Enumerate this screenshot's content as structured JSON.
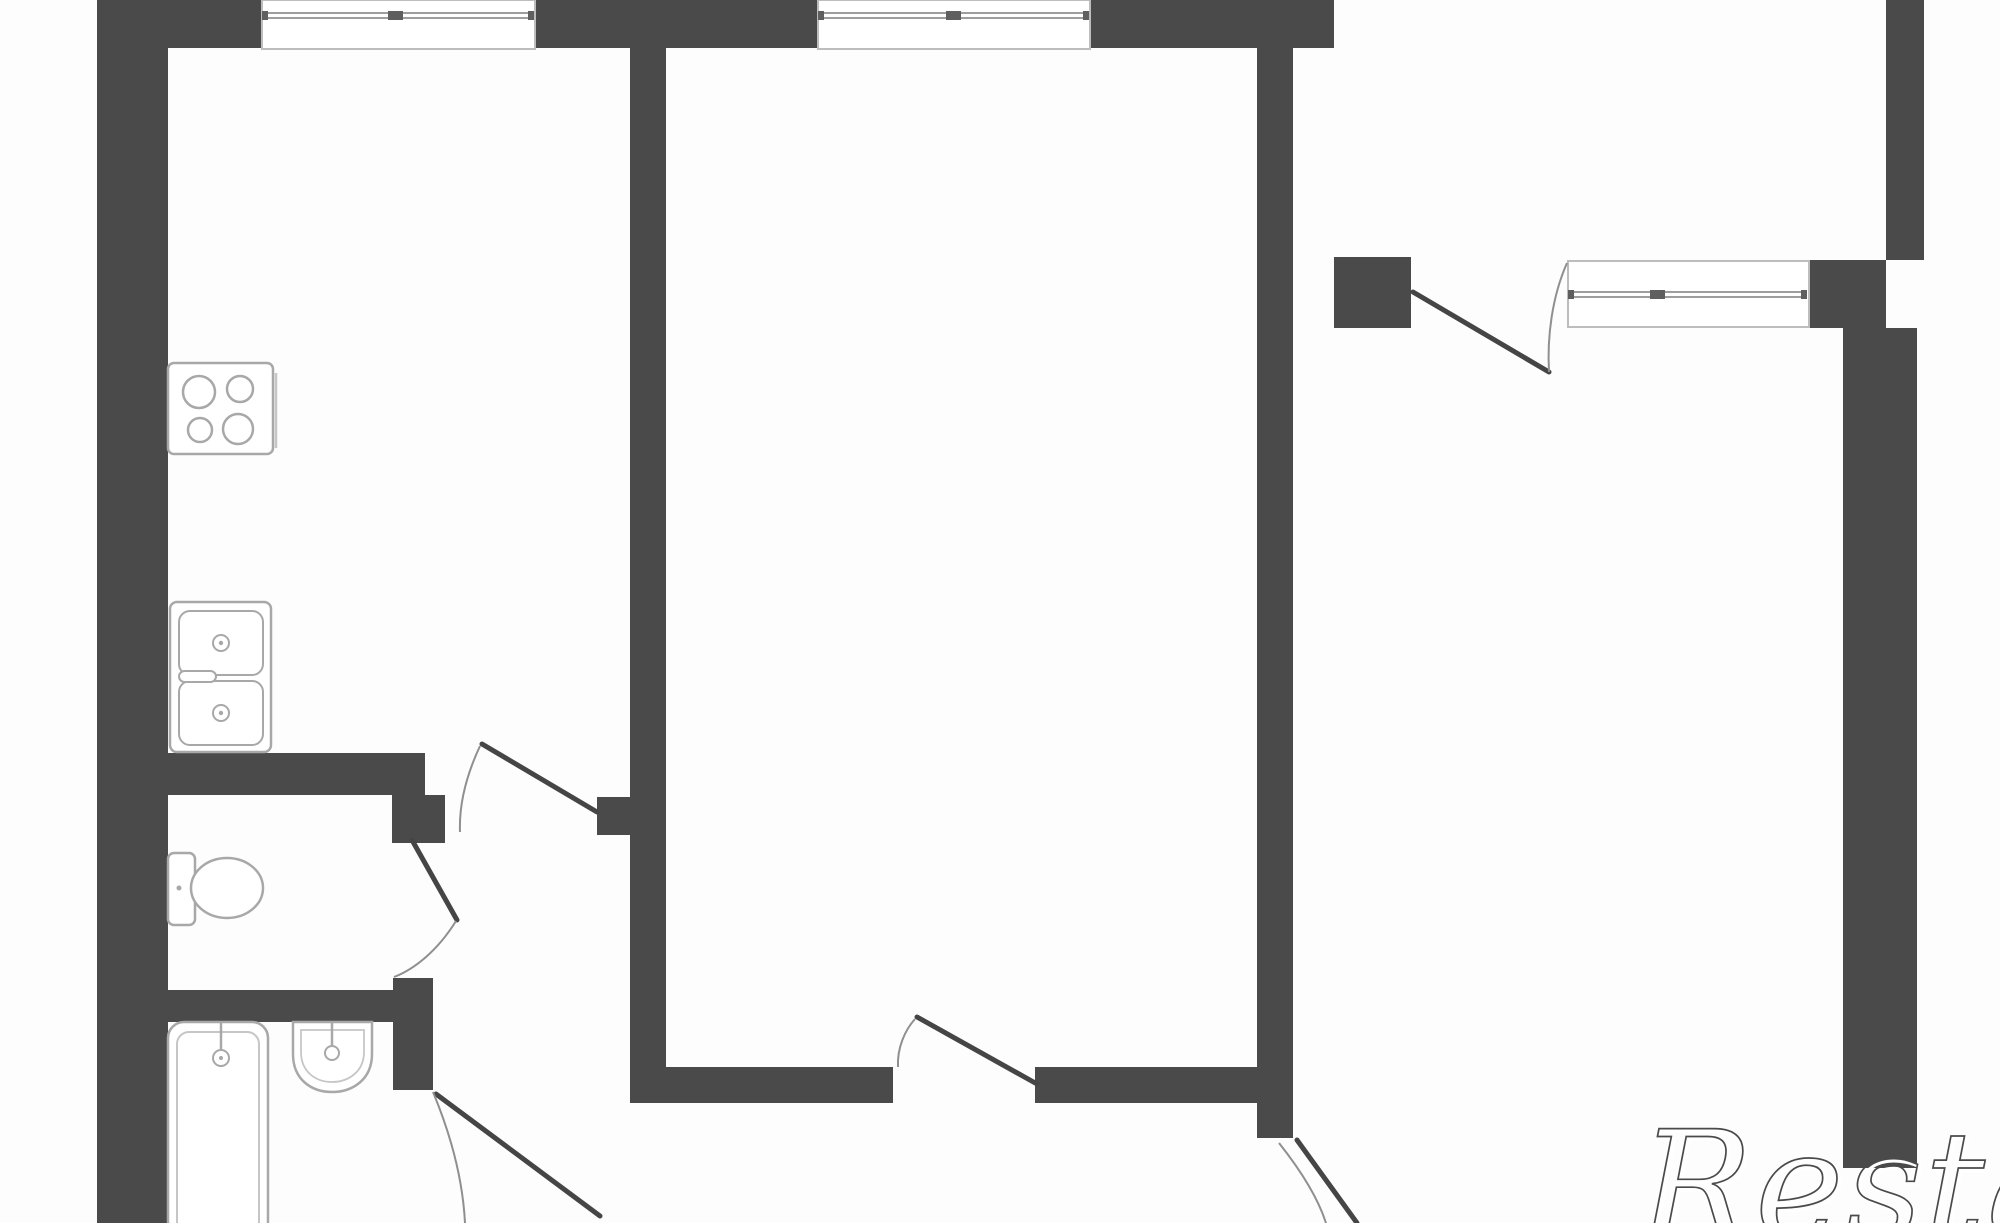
{
  "meta": {
    "title": "apartment-floor-plan",
    "canvas": {
      "width": 2000,
      "height": 1223,
      "background": "#fdfdfd"
    }
  },
  "watermark": {
    "text": "Restate"
  },
  "colors": {
    "wall": "#4a4a4a",
    "fixture": "#a8a8a8",
    "light": "#c6c6c6",
    "glass": "#9e9e9e",
    "frame": "#bdbdbd",
    "door": "#454545",
    "arc": "#8f8f8f",
    "tick": "#5f5f5f",
    "white": "#ffffff",
    "wmdark": "#4a4a4a"
  },
  "elements": [
    {
      "name": "walls",
      "type": "g",
      "items": [
        {
          "name": "left-outer-wall",
          "type": "rect",
          "x": 97,
          "y": 0,
          "w": 71,
          "h": 1223,
          "fill": "wall"
        },
        {
          "name": "top-wall-west",
          "type": "rect",
          "x": 97,
          "y": 0,
          "w": 165,
          "h": 48,
          "fill": "wall"
        },
        {
          "name": "top-wall-center",
          "type": "rect",
          "x": 535,
          "y": 0,
          "w": 283,
          "h": 48,
          "fill": "wall"
        },
        {
          "name": "top-wall-east",
          "type": "rect",
          "x": 1090,
          "y": 0,
          "w": 244,
          "h": 48,
          "fill": "wall"
        },
        {
          "name": "kitchen-livingroom-wall",
          "type": "rect",
          "x": 630,
          "y": 48,
          "w": 36,
          "h": 1052,
          "fill": "wall"
        },
        {
          "name": "kitchen-door-jamb",
          "type": "rect",
          "x": 597,
          "y": 797,
          "w": 36,
          "h": 38,
          "fill": "wall"
        },
        {
          "name": "kitchen-wc-wall",
          "type": "rect",
          "x": 140,
          "y": 753,
          "w": 285,
          "h": 42,
          "fill": "wall"
        },
        {
          "name": "wc-door-jamb",
          "type": "rect",
          "x": 392,
          "y": 795,
          "w": 53,
          "h": 48,
          "fill": "wall"
        },
        {
          "name": "wc-bathroom-wall",
          "type": "rect",
          "x": 140,
          "y": 990,
          "w": 253,
          "h": 32,
          "fill": "wall"
        },
        {
          "name": "bathroom-door-jamb",
          "type": "rect",
          "x": 393,
          "y": 978,
          "w": 40,
          "h": 112,
          "fill": "wall"
        },
        {
          "name": "hall-south-wall-west",
          "type": "rect",
          "x": 630,
          "y": 1067,
          "w": 263,
          "h": 36,
          "fill": "wall"
        },
        {
          "name": "hall-south-wall-east",
          "type": "rect",
          "x": 1035,
          "y": 1067,
          "w": 222,
          "h": 36,
          "fill": "wall"
        },
        {
          "name": "livingroom-right-wall",
          "type": "rect",
          "x": 1257,
          "y": 48,
          "w": 36,
          "h": 1090,
          "fill": "wall"
        },
        {
          "name": "rightroom-door-jamb",
          "type": "rect",
          "x": 1334,
          "y": 257,
          "w": 77,
          "h": 71,
          "fill": "wall"
        },
        {
          "name": "rightroom-window-pier",
          "type": "rect",
          "x": 1809,
          "y": 260,
          "w": 77,
          "h": 68,
          "fill": "wall"
        },
        {
          "name": "right-outer-wall-upper",
          "type": "rect",
          "x": 1886,
          "y": 0,
          "w": 38,
          "h": 260,
          "fill": "wall"
        },
        {
          "name": "right-outer-wall-lower",
          "type": "rect",
          "x": 1843,
          "y": 328,
          "w": 74,
          "h": 840,
          "fill": "wall"
        }
      ]
    },
    {
      "name": "kitchen-window",
      "type": "g",
      "items": [
        {
          "name": "window-box",
          "type": "rect",
          "x": 262,
          "y": 0,
          "w": 273,
          "h": 49,
          "fill": "white",
          "stroke": "frame",
          "sw": 2
        },
        {
          "name": "window-glass-line",
          "type": "line",
          "x1": 264,
          "y1": 13,
          "x2": 533,
          "y2": 13,
          "stroke": "glass",
          "sw": 2
        },
        {
          "name": "window-glass-line",
          "type": "line",
          "x1": 264,
          "y1": 18,
          "x2": 533,
          "y2": 18,
          "stroke": "glass",
          "sw": 2
        },
        {
          "name": "window-end-cap",
          "type": "rect",
          "x": 262,
          "y": 11,
          "w": 6,
          "h": 9,
          "fill": "tick"
        },
        {
          "name": "window-end-cap",
          "type": "rect",
          "x": 528,
          "y": 11,
          "w": 6,
          "h": 9,
          "fill": "tick"
        },
        {
          "name": "window-center-tick",
          "type": "rect",
          "x": 388,
          "y": 11,
          "w": 15,
          "h": 9,
          "fill": "tick"
        }
      ]
    },
    {
      "name": "livingroom-window",
      "type": "g",
      "items": [
        {
          "name": "window-box",
          "type": "rect",
          "x": 818,
          "y": 0,
          "w": 272,
          "h": 49,
          "fill": "white",
          "stroke": "frame",
          "sw": 2
        },
        {
          "name": "window-glass-line",
          "type": "line",
          "x1": 820,
          "y1": 13,
          "x2": 1088,
          "y2": 13,
          "stroke": "glass",
          "sw": 2
        },
        {
          "name": "window-glass-line",
          "type": "line",
          "x1": 820,
          "y1": 18,
          "x2": 1088,
          "y2": 18,
          "stroke": "glass",
          "sw": 2
        },
        {
          "name": "window-end-cap",
          "type": "rect",
          "x": 818,
          "y": 11,
          "w": 6,
          "h": 9,
          "fill": "tick"
        },
        {
          "name": "window-end-cap",
          "type": "rect",
          "x": 1083,
          "y": 11,
          "w": 6,
          "h": 9,
          "fill": "tick"
        },
        {
          "name": "window-center-tick",
          "type": "rect",
          "x": 946,
          "y": 11,
          "w": 15,
          "h": 9,
          "fill": "tick"
        }
      ]
    },
    {
      "name": "rightroom-window",
      "type": "g",
      "items": [
        {
          "name": "window-box",
          "type": "rect",
          "x": 1568,
          "y": 261,
          "w": 241,
          "h": 66,
          "fill": "white",
          "stroke": "frame",
          "sw": 2
        },
        {
          "name": "window-glass-line",
          "type": "line",
          "x1": 1570,
          "y1": 292,
          "x2": 1807,
          "y2": 292,
          "stroke": "glass",
          "sw": 2
        },
        {
          "name": "window-glass-line",
          "type": "line",
          "x1": 1570,
          "y1": 297,
          "x2": 1807,
          "y2": 297,
          "stroke": "glass",
          "sw": 2
        },
        {
          "name": "window-end-cap",
          "type": "rect",
          "x": 1568,
          "y": 290,
          "w": 6,
          "h": 9,
          "fill": "tick"
        },
        {
          "name": "window-end-cap",
          "type": "rect",
          "x": 1801,
          "y": 290,
          "w": 6,
          "h": 9,
          "fill": "tick"
        },
        {
          "name": "window-center-tick",
          "type": "rect",
          "x": 1650,
          "y": 290,
          "w": 15,
          "h": 9,
          "fill": "tick"
        }
      ]
    },
    {
      "name": "kitchen-door-swing",
      "type": "g",
      "items": [
        {
          "name": "door-leaf",
          "type": "line",
          "x1": 597,
          "y1": 812,
          "x2": 482,
          "y2": 744,
          "stroke": "door",
          "sw": 5,
          "cap": "round"
        },
        {
          "name": "door-arc",
          "type": "path",
          "d": "M 480 746 C 466 776 459 806 460 832",
          "stroke": "arc",
          "sw": 2,
          "fill": "none"
        }
      ]
    },
    {
      "name": "wc-door-swing",
      "type": "g",
      "items": [
        {
          "name": "door-leaf",
          "type": "line",
          "x1": 412,
          "y1": 840,
          "x2": 457,
          "y2": 920,
          "stroke": "door",
          "sw": 5,
          "cap": "round"
        },
        {
          "name": "door-arc",
          "type": "path",
          "d": "M 456 921 C 438 950 415 969 394 977",
          "stroke": "arc",
          "sw": 2,
          "fill": "none"
        }
      ]
    },
    {
      "name": "bathroom-door-swing",
      "type": "g",
      "items": [
        {
          "name": "door-leaf",
          "type": "line",
          "x1": 436,
          "y1": 1094,
          "x2": 600,
          "y2": 1216,
          "stroke": "door",
          "sw": 5,
          "cap": "round"
        },
        {
          "name": "door-arc",
          "type": "path",
          "d": "M 433 1092 C 453 1140 463 1184 465 1223",
          "stroke": "arc",
          "sw": 2,
          "fill": "none"
        }
      ]
    },
    {
      "name": "livingroom-door-swing",
      "type": "g",
      "items": [
        {
          "name": "door-leaf",
          "type": "line",
          "x1": 917,
          "y1": 1017,
          "x2": 1037,
          "y2": 1084,
          "stroke": "door",
          "sw": 5,
          "cap": "round"
        },
        {
          "name": "door-arc",
          "type": "path",
          "d": "M 898 1067 C 897 1048 905 1030 915 1019",
          "stroke": "arc",
          "sw": 2,
          "fill": "none"
        }
      ]
    },
    {
      "name": "rightroom-door-swing",
      "type": "g",
      "items": [
        {
          "name": "door-leaf",
          "type": "line",
          "x1": 1413,
          "y1": 292,
          "x2": 1549,
          "y2": 372,
          "stroke": "door",
          "sw": 5,
          "cap": "round"
        },
        {
          "name": "door-arc",
          "type": "path",
          "d": "M 1567 263 C 1552 297 1547 337 1549 372",
          "stroke": "arc",
          "sw": 2,
          "fill": "none"
        }
      ]
    },
    {
      "name": "entry-door-swing",
      "type": "g",
      "items": [
        {
          "name": "door-leaf",
          "type": "line",
          "x1": 1297,
          "y1": 1140,
          "x2": 1357,
          "y2": 1223,
          "stroke": "door",
          "sw": 5,
          "cap": "round"
        },
        {
          "name": "door-arc",
          "type": "path",
          "d": "M 1279 1143 C 1302 1172 1318 1198 1326 1223",
          "stroke": "arc",
          "sw": 2,
          "fill": "none"
        }
      ]
    },
    {
      "name": "stove",
      "type": "g",
      "items": [
        {
          "name": "stove-body",
          "type": "rect",
          "x": 168,
          "y": 363,
          "w": 105,
          "h": 91,
          "rx": 6,
          "fill": "white",
          "stroke": "fixture",
          "sw": 2.5
        },
        {
          "name": "stove-shadow-line",
          "type": "line",
          "x1": 276,
          "y1": 373,
          "x2": 276,
          "y2": 448,
          "stroke": "light",
          "sw": 2.5
        },
        {
          "name": "stove-burner",
          "type": "circle",
          "cx": 199,
          "cy": 392,
          "r": 16,
          "fill": "none",
          "stroke": "fixture",
          "sw": 2.5
        },
        {
          "name": "stove-burner",
          "type": "circle",
          "cx": 240,
          "cy": 389,
          "r": 13,
          "fill": "none",
          "stroke": "fixture",
          "sw": 2.5
        },
        {
          "name": "stove-burner",
          "type": "circle",
          "cx": 200,
          "cy": 430,
          "r": 12,
          "fill": "none",
          "stroke": "fixture",
          "sw": 2.5
        },
        {
          "name": "stove-burner",
          "type": "circle",
          "cx": 238,
          "cy": 429,
          "r": 15,
          "fill": "none",
          "stroke": "fixture",
          "sw": 2.5
        }
      ]
    },
    {
      "name": "kitchen-sink",
      "type": "g",
      "items": [
        {
          "name": "sink-body",
          "type": "rect",
          "x": 170,
          "y": 602,
          "w": 101,
          "h": 150,
          "rx": 7,
          "fill": "white",
          "stroke": "fixture",
          "sw": 2.5
        },
        {
          "name": "sink-basin",
          "type": "rect",
          "x": 179,
          "y": 611,
          "w": 84,
          "h": 64,
          "rx": 11,
          "fill": "none",
          "stroke": "fixture",
          "sw": 2
        },
        {
          "name": "sink-basin",
          "type": "rect",
          "x": 179,
          "y": 681,
          "w": 84,
          "h": 64,
          "rx": 11,
          "fill": "none",
          "stroke": "fixture",
          "sw": 2
        },
        {
          "name": "sink-drain",
          "type": "circle",
          "cx": 221,
          "cy": 643,
          "r": 8,
          "fill": "none",
          "stroke": "fixture",
          "sw": 2
        },
        {
          "name": "sink-drain-dot",
          "type": "circle",
          "cx": 221,
          "cy": 643,
          "r": 2.2,
          "fill": "fixture"
        },
        {
          "name": "sink-drain",
          "type": "circle",
          "cx": 221,
          "cy": 713,
          "r": 8,
          "fill": "none",
          "stroke": "fixture",
          "sw": 2
        },
        {
          "name": "sink-drain-dot",
          "type": "circle",
          "cx": 221,
          "cy": 713,
          "r": 2.2,
          "fill": "fixture"
        },
        {
          "name": "sink-faucet",
          "type": "rect",
          "x": 179,
          "y": 671,
          "w": 37,
          "h": 11,
          "rx": 5.5,
          "fill": "white",
          "stroke": "fixture",
          "sw": 2
        }
      ]
    },
    {
      "name": "toilet",
      "type": "g",
      "items": [
        {
          "name": "toilet-tank",
          "type": "rect",
          "x": 168,
          "y": 853,
          "w": 27,
          "h": 72,
          "rx": 6,
          "fill": "white",
          "stroke": "fixture",
          "sw": 2.5
        },
        {
          "name": "toilet-tank-dot",
          "type": "circle",
          "cx": 179,
          "cy": 888,
          "r": 2.5,
          "fill": "fixture"
        },
        {
          "name": "toilet-bowl",
          "type": "ellipse",
          "cx": 227,
          "cy": 888,
          "rx": 36,
          "ry": 30,
          "fill": "white",
          "stroke": "fixture",
          "sw": 2.5
        }
      ]
    },
    {
      "name": "bathtub",
      "type": "g",
      "items": [
        {
          "name": "tub-outer",
          "type": "rect",
          "x": 168,
          "y": 1022,
          "w": 100,
          "h": 215,
          "rx": 16,
          "fill": "white",
          "stroke": "fixture",
          "sw": 2.5
        },
        {
          "name": "tub-inner",
          "type": "rect",
          "x": 177,
          "y": 1032,
          "w": 82,
          "h": 205,
          "rx": 12,
          "fill": "none",
          "stroke": "light",
          "sw": 2
        },
        {
          "name": "tub-tap-pipe",
          "type": "line",
          "x1": 221,
          "y1": 1022,
          "x2": 221,
          "y2": 1049,
          "stroke": "fixture",
          "sw": 2.5
        },
        {
          "name": "tub-tap",
          "type": "circle",
          "cx": 221,
          "cy": 1058,
          "r": 8,
          "fill": "white",
          "stroke": "fixture",
          "sw": 2
        },
        {
          "name": "tub-tap-dot",
          "type": "circle",
          "cx": 221,
          "cy": 1058,
          "r": 2,
          "fill": "fixture"
        }
      ]
    },
    {
      "name": "washbasin",
      "type": "g",
      "items": [
        {
          "name": "basin-bowl",
          "type": "path",
          "d": "M 293 1022 L 372 1022 L 372 1054 C 372 1080 352 1092 332 1092 C 312 1092 293 1080 293 1054 Z",
          "fill": "white",
          "stroke": "fixture",
          "sw": 2.5
        },
        {
          "name": "basin-inner",
          "type": "path",
          "d": "M 301 1030 L 364 1030 L 364 1052 C 364 1072 348 1082 332 1082 C 316 1082 301 1072 301 1052 Z",
          "fill": "none",
          "stroke": "light",
          "sw": 1.8
        },
        {
          "name": "basin-tap-pipe",
          "type": "line",
          "x1": 332,
          "y1": 1022,
          "x2": 332,
          "y2": 1047,
          "stroke": "fixture",
          "sw": 2.5
        },
        {
          "name": "basin-tap",
          "type": "circle",
          "cx": 332,
          "cy": 1053,
          "r": 7,
          "fill": "white",
          "stroke": "fixture",
          "sw": 2
        }
      ]
    },
    {
      "name": "watermark",
      "type": "g",
      "items": [
        {
          "name": "watermark-text-shadow",
          "type": "text",
          "x": 1643,
          "y": 1241,
          "fs": 150,
          "ls": 2,
          "fill": "none",
          "stroke": "white",
          "sw": 3,
          "cls": "wm-text",
          "bind": "watermark.text"
        },
        {
          "name": "watermark-text",
          "type": "text",
          "x": 1640,
          "y": 1238,
          "fs": 150,
          "ls": 2,
          "fill": "none",
          "stroke": "wmdark",
          "sw": 1.7,
          "cls": "wm-text",
          "bind": "watermark.text"
        }
      ]
    }
  ]
}
